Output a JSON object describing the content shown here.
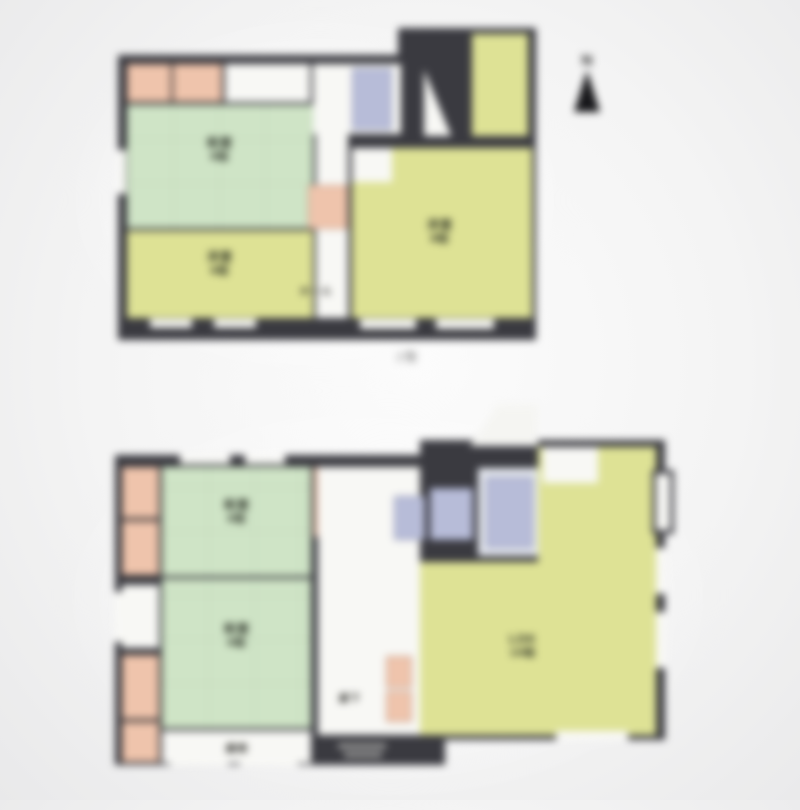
{
  "compass": {
    "label": "N"
  },
  "floor_2f": {
    "caption": "2階",
    "rooms": {
      "washitsu": {
        "name": "和室",
        "size": "8帖"
      },
      "youshitsu_small": {
        "name": "洋室",
        "size": "6帖"
      },
      "youshitsu_large": {
        "name": "洋室",
        "size": "8帖"
      },
      "hall": {
        "name": "ホール"
      }
    }
  },
  "floor_1f": {
    "rooms": {
      "washitsu_a": {
        "name": "和室",
        "size": "6帖"
      },
      "washitsu_b": {
        "name": "和室",
        "size": "6帖"
      },
      "ldk": {
        "name": "LDK",
        "size": "16帖"
      },
      "hallway": {
        "name": "廊下"
      },
      "veranda": {
        "name": "縁側"
      }
    }
  },
  "palette": {
    "wall": "#3a3a40",
    "tatami_green": "#cfe4c6",
    "western_yellow": "#dee295",
    "closet_salmon": "#efc4ac",
    "wet_blue": "#b7bcd8",
    "floor_white": "#f8f8f5",
    "background": "#f4f4f4"
  }
}
